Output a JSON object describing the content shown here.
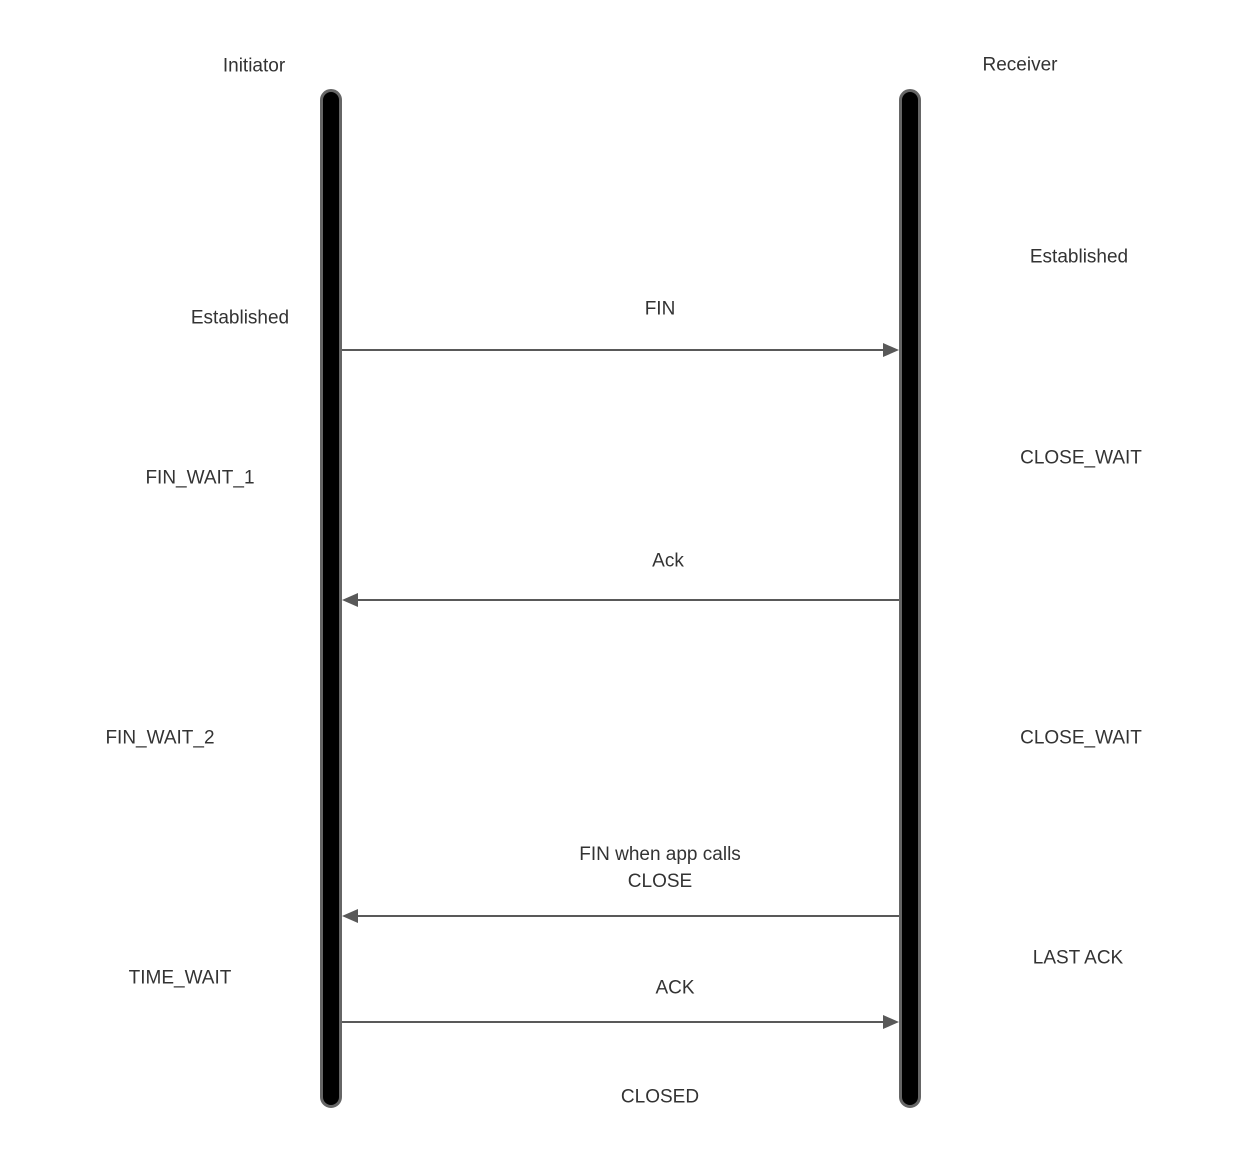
{
  "diagram": {
    "type": "sequence",
    "subject": "TCP connection termination",
    "actors": {
      "initiator": "Initiator",
      "receiver": "Receiver"
    },
    "initiator_states": [
      {
        "label": "Established"
      },
      {
        "label": "FIN_WAIT_1"
      },
      {
        "label": "FIN_WAIT_2"
      },
      {
        "label": "TIME_WAIT"
      }
    ],
    "receiver_states": [
      {
        "label": "Established"
      },
      {
        "label": "CLOSE_WAIT"
      },
      {
        "label": "CLOSE_WAIT"
      },
      {
        "label": "LAST ACK"
      }
    ],
    "messages": [
      {
        "direction": "left-to-right",
        "lines": [
          "FIN"
        ]
      },
      {
        "direction": "right-to-left",
        "lines": [
          "Ack"
        ]
      },
      {
        "direction": "right-to-left",
        "lines": [
          "FIN when app calls",
          "CLOSE"
        ]
      },
      {
        "direction": "left-to-right",
        "lines": [
          "ACK"
        ]
      }
    ],
    "final_state": "CLOSED",
    "colors": {
      "background": "#ffffff",
      "lifeline_fill": "#000000",
      "lifeline_border": "#666666",
      "arrow": "#595959",
      "text": "#333333"
    }
  }
}
